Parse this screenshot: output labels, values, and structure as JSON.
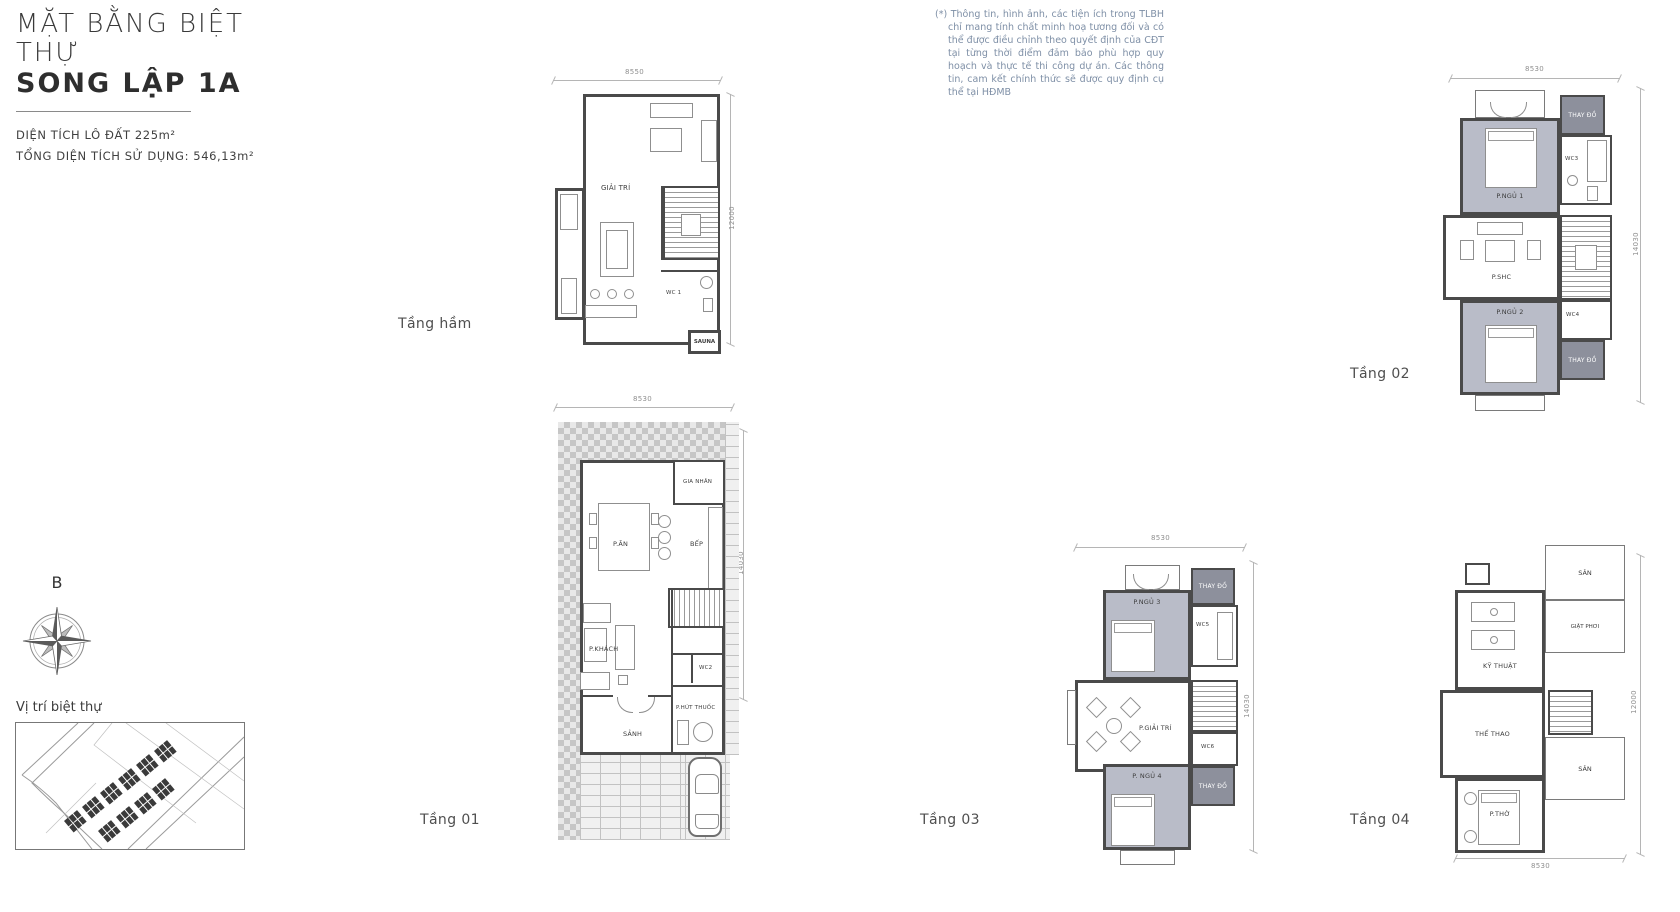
{
  "header": {
    "title_line1": "MẶT BẰNG BIỆT THỰ",
    "title_line2": "SONG LẬP 1A",
    "lot_area": "DIỆN TÍCH LÔ ĐẤT 225m²",
    "total_area": "TỔNG DIỆN TÍCH SỬ DỤNG: 546,13m²"
  },
  "disclaimer": "(*) Thông tin, hình ảnh, các tiện ích trong TLBH chỉ mang tính chất minh hoạ tương đối và có thể được điều chỉnh theo quyết định của CĐT tại từng thời điểm đảm bảo phù hợp quy hoạch và thực tế thi công dự án. Các thông tin, cam kết chính thức sẽ được quy định cụ thể tại HĐMB",
  "compass": {
    "north_label": "B"
  },
  "location_caption": "Vị trí biệt thự",
  "floors": {
    "basement": {
      "name": "Tầng hầm",
      "dim_top": "8550",
      "dim_right": "12000",
      "rooms": {
        "entertainment": "GIẢI TRÍ",
        "wc1": "WC 1",
        "sauna": "SAUNA"
      }
    },
    "floor1": {
      "name": "Tầng 01",
      "dim_top": "8530",
      "dim_right": "14030",
      "rooms": {
        "maid": "GIA NHÂN",
        "dining": "P.ĂN",
        "kitchen": "BẾP",
        "living": "P.KHÁCH",
        "wc2": "WC2",
        "smoking": "P.HÚT THUỐC",
        "lobby": "SẢNH"
      }
    },
    "floor2": {
      "name": "Tầng 02",
      "dim_top": "8530",
      "dim_right": "14030",
      "rooms": {
        "bedroom1": "P.NGỦ 1",
        "dressing_top": "THAY ĐỒ",
        "wc3": "WC3",
        "family": "P.SHC",
        "bedroom2": "P.NGỦ 2",
        "wc4": "WC4",
        "dressing_bottom": "THAY ĐỒ"
      }
    },
    "floor3": {
      "name": "Tầng 03",
      "dim_top": "8530",
      "dim_right": "14030",
      "rooms": {
        "bedroom3": "P.NGỦ 3",
        "dressing_top": "THAY ĐỒ",
        "wc5": "WC5",
        "entertainment": "P.GIẢI TRÍ",
        "bedroom4": "P. NGỦ 4",
        "wc6": "WC6",
        "dressing_bottom": "THAY ĐỒ"
      }
    },
    "floor4": {
      "name": "Tầng 04",
      "dim_bottom": "8530",
      "dim_right": "12000",
      "rooms": {
        "technical": "KỸ THUẬT",
        "yard_top": "SÂN",
        "laundry": "GIẶT PHƠI",
        "sport": "THỂ THAO",
        "worship": "P.THỜ",
        "yard_bottom": "SÂN"
      }
    }
  },
  "colors": {
    "wall": "#4a4a4a",
    "room_gray_fill": "#b9bcc8",
    "room_dark_fill": "#8d909c",
    "disclaimer_text": "#7e8fa6",
    "title_text": "#2e2e2e"
  }
}
